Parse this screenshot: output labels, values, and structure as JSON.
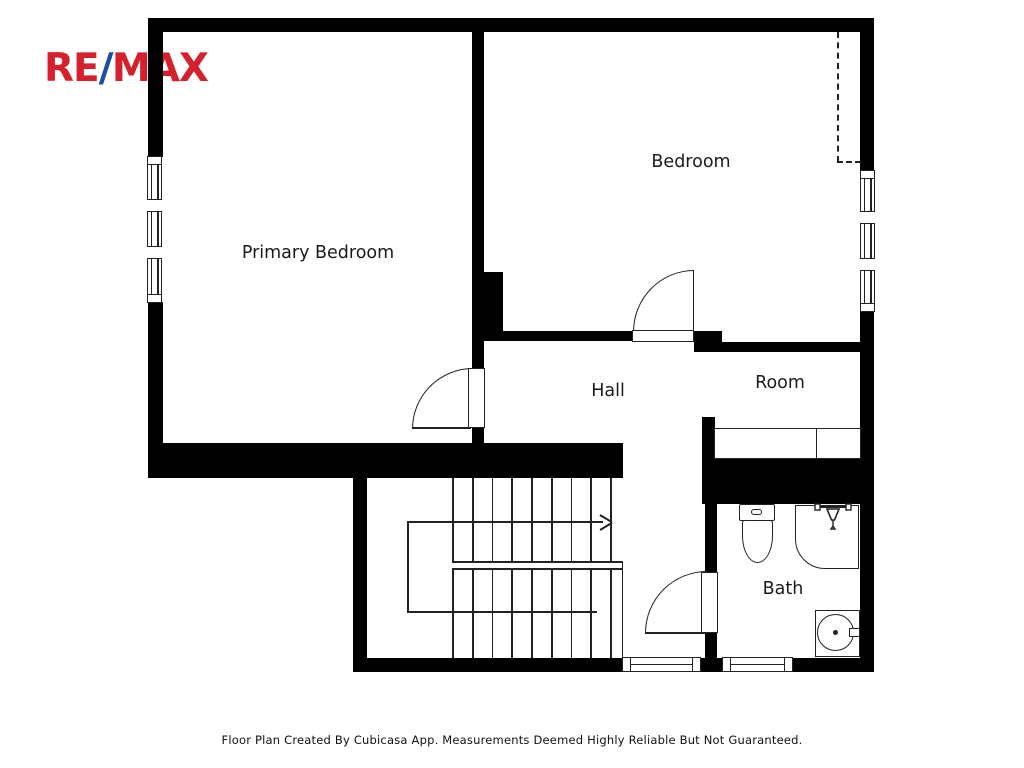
{
  "logo": {
    "part1": "RE",
    "slash": "/",
    "part2": "MAX"
  },
  "colors": {
    "wall": "#000000",
    "line": "#222222",
    "logo_red": "#D7202E",
    "logo_blue": "#1B4FA0"
  },
  "rooms": {
    "primary_bedroom": "Primary Bedroom",
    "bedroom": "Bedroom",
    "hall": "Hall",
    "room": "Room",
    "bath": "Bath"
  },
  "footer": {
    "text": "Floor Plan Created By Cubicasa App. Measurements Deemed Highly Reliable But Not Guaranteed."
  },
  "stairs": {
    "tread_count": 9,
    "tread_start_x": 452,
    "tread_spacing": 19.75,
    "upper_flight": {
      "top": 478,
      "bottom": 562
    },
    "lower_flight": {
      "top": 570,
      "bottom": 658
    }
  }
}
